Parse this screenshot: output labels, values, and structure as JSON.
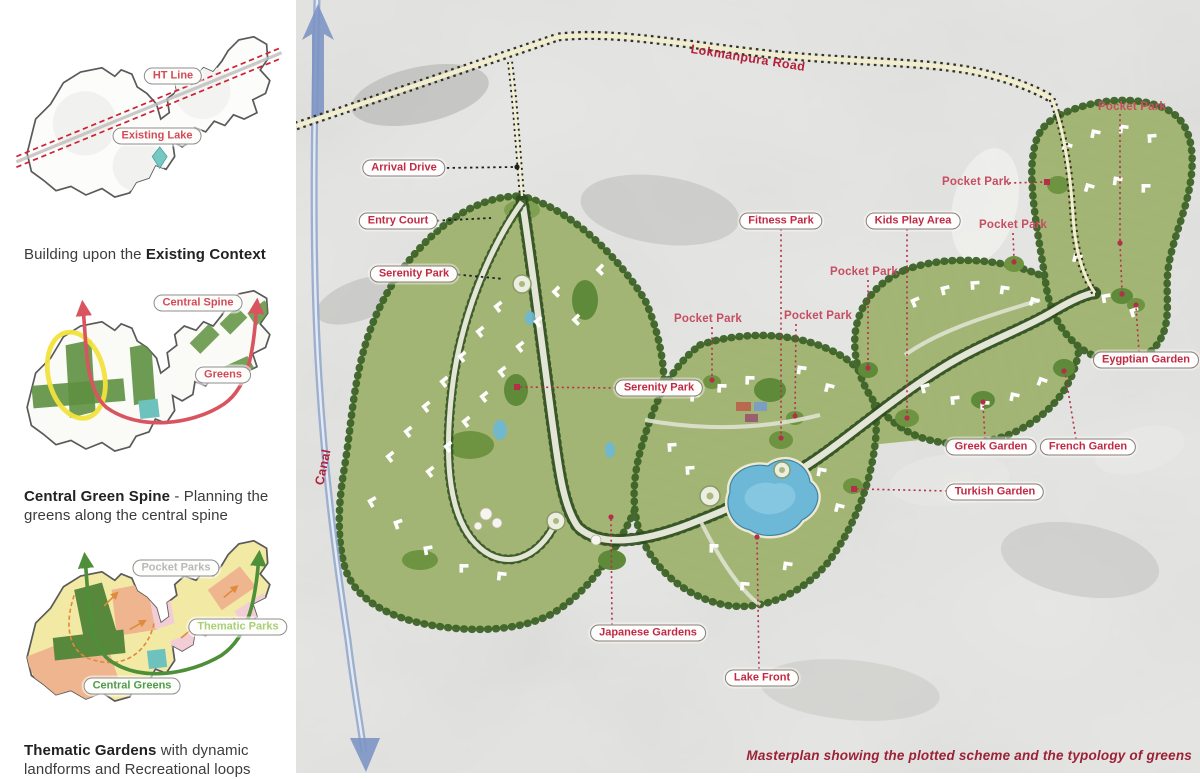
{
  "sidebar": {
    "fig1": {
      "ht_line": "HT Line",
      "existing_lake": "Existing Lake",
      "caption_normal": "Building upon the ",
      "caption_bold": "Existing Context"
    },
    "fig2": {
      "central_spine": "Central Spine",
      "greens": "Greens",
      "caption_bold": "Central Green Spine",
      "caption_normal": " - Planning the greens along the central spine"
    },
    "fig3": {
      "pocket_parks": "Pocket Parks",
      "thematic_parks": "Thematic Parks",
      "central_greens": "Central Greens",
      "caption_bold": "Thematic Gardens",
      "caption_normal": " with dynamic landforms and Recreational loops"
    }
  },
  "map": {
    "road": "Lokmanpura Road",
    "canal": "Canal",
    "caption": "Masterplan showing the plotted scheme and the typology of greens",
    "labels": {
      "arrival_drive": "Arrival Drive",
      "entry_court": "Entry Court",
      "serenity_park": "Serenity Park",
      "fitness_park": "Fitness Park",
      "kids_play_area": "Kids Play Area",
      "pocket_park": "Pocket Park",
      "eygptian_garden": "Eygptian Garden",
      "greek_garden": "Greek Garden",
      "french_garden": "French Garden",
      "turkish_garden": "Turkish Garden",
      "japanese_gardens": "Japanese Gardens",
      "lake_front": "Lake Front"
    }
  },
  "colors": {
    "label_red": "#c22a44",
    "plain_label_red": "#c64d62",
    "road_label_red": "#b5213a",
    "caption_red": "#9c2136",
    "canal_blue": "#8fa6c9",
    "development_green": "#a3b575",
    "tree_green": "#3d6327",
    "lake_blue": "#6cb8d6",
    "ht_line_red": "#cc2233",
    "spine_red": "#d85560",
    "spine_green": "#4e8f3a",
    "thematic_yellow": "#f2e9a4",
    "aerial_gray": "#d6d6d4"
  }
}
